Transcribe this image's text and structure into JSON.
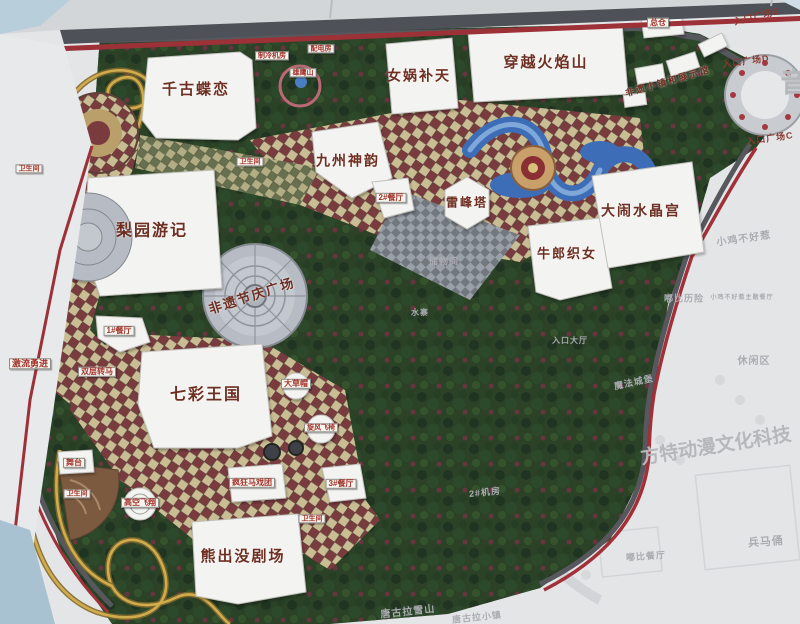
{
  "meta": {
    "description": "Photograph of a printed theme-park master-plan map board (Fantawild-style Chinese theme park). Colourful phase highlighted; adjacent areas shown faded grey.",
    "board_type": "site plan map"
  },
  "palette": {
    "board": "#e4e5e7",
    "park-green": "#2b4227",
    "checker-tan": "#c9bd93",
    "checker-maroon": "#7a3b3f",
    "checker-olive": "#66704e",
    "plaza": "#b7bcc4",
    "water": "#3e6db8",
    "road-red": "#a23038",
    "road-gray": "#56585e",
    "coaster": "#d0ac4d",
    "building": "#f3f3f1",
    "label-red": "#6e2f22",
    "faded-text": "#aaacb1"
  },
  "labels": {
    "attractions": [
      {
        "id": "qiangudielian",
        "text": "千古蝶恋",
        "x": 196,
        "y": 90,
        "size": 15
      },
      {
        "id": "nvwabutian",
        "text": "女娲补天",
        "x": 419,
        "y": 76,
        "size": 14
      },
      {
        "id": "chuanyuehuoyanshan",
        "text": "穿越火焰山",
        "x": 546,
        "y": 63,
        "size": 15
      },
      {
        "id": "jiuzhoushenyun",
        "text": "九州神韵",
        "x": 348,
        "y": 161,
        "size": 14
      },
      {
        "id": "liyuanyouji",
        "text": "梨园游记",
        "x": 152,
        "y": 232,
        "size": 16
      },
      {
        "id": "leifengta",
        "text": "雷峰塔",
        "x": 467,
        "y": 203,
        "size": 12
      },
      {
        "id": "niulangzhinv",
        "text": "牛郎织女",
        "x": 567,
        "y": 254,
        "size": 13
      },
      {
        "id": "danaoshuijinggong",
        "text": "大闹水晶宫",
        "x": 641,
        "y": 211,
        "size": 14
      },
      {
        "id": "qicaiwangguo",
        "text": "七彩王国",
        "x": 206,
        "y": 396,
        "size": 16
      },
      {
        "id": "xiongchumojuchang",
        "text": "熊出没剧场",
        "x": 243,
        "y": 557,
        "size": 15
      },
      {
        "id": "feiyijieqingguangchang",
        "text": "非遗节庆广场",
        "x": 252,
        "y": 296,
        "size": 13,
        "rot": -18
      },
      {
        "id": "feiyixiaozhen",
        "text": "非遗小镇和展示馆",
        "x": 668,
        "y": 82,
        "size": 9,
        "rot": -16
      }
    ],
    "facilities": [
      {
        "id": "zongcang",
        "text": "总仓",
        "x": 658,
        "y": 23,
        "size": 8
      },
      {
        "id": "zhilengjifang",
        "text": "制冷机房",
        "x": 272,
        "y": 56,
        "size": 7
      },
      {
        "id": "peidianfang",
        "text": "配电房",
        "x": 321,
        "y": 49,
        "size": 7
      },
      {
        "id": "xiongyingshan",
        "text": "雄鹰山",
        "x": 303,
        "y": 73,
        "size": 7
      },
      {
        "id": "weishengjian-1",
        "text": "卫生间",
        "x": 29,
        "y": 169,
        "size": 7
      },
      {
        "id": "weishengjian-2",
        "text": "卫生间",
        "x": 250,
        "y": 162,
        "size": 7
      },
      {
        "id": "weishengjian-3",
        "text": "卫生间",
        "x": 77,
        "y": 494,
        "size": 7
      },
      {
        "id": "weishengjian-4",
        "text": "卫生间",
        "x": 312,
        "y": 519,
        "size": 7
      },
      {
        "id": "canting-1",
        "text": "1#餐厅",
        "x": 119,
        "y": 331,
        "size": 8
      },
      {
        "id": "canting-2",
        "text": "2#餐厅",
        "x": 391,
        "y": 198,
        "size": 8
      },
      {
        "id": "canting-3",
        "text": "3#餐厅",
        "x": 341,
        "y": 484,
        "size": 8
      },
      {
        "id": "dacaomao",
        "text": "大草帽",
        "x": 296,
        "y": 384,
        "size": 8
      },
      {
        "id": "xuanfengfeiyi",
        "text": "旋风飞椅",
        "x": 321,
        "y": 428,
        "size": 7
      },
      {
        "id": "shuangcengzhuanma",
        "text": "双层转马",
        "x": 97,
        "y": 372,
        "size": 8
      },
      {
        "id": "gaokongfeixiang",
        "text": "高空飞翔",
        "x": 140,
        "y": 503,
        "size": 8
      },
      {
        "id": "wutai",
        "text": "舞台",
        "x": 74,
        "y": 463,
        "size": 8
      },
      {
        "id": "fengkuangmaxituan",
        "text": "疯狂马戏团",
        "x": 252,
        "y": 483,
        "size": 8
      },
      {
        "id": "jiliuyongjin",
        "text": "激流勇进",
        "x": 30,
        "y": 364,
        "size": 9
      }
    ],
    "entrances": [
      {
        "id": "rukouguangchang-E",
        "text": "入口广场E",
        "x": 757,
        "y": 17,
        "size": 9,
        "rot": -14
      },
      {
        "id": "rukouguangchang-D",
        "text": "入口广场D",
        "x": 746,
        "y": 62,
        "size": 9,
        "rot": -8
      },
      {
        "id": "rukouguangchang-C",
        "text": "入口广场C",
        "x": 770,
        "y": 139,
        "size": 9,
        "rot": -8
      }
    ],
    "faded": [
      {
        "id": "chuwujian",
        "text": "储物间",
        "x": 444,
        "y": 262,
        "size": 9
      },
      {
        "id": "xiaojibuhaore",
        "text": "小鸡不好惹",
        "x": 744,
        "y": 240,
        "size": 10,
        "rot": -8
      },
      {
        "id": "dubilixian",
        "text": "嘟比历险",
        "x": 684,
        "y": 299,
        "size": 9
      },
      {
        "id": "xiaojicanting",
        "text": "小鸡不好惹主题餐厅",
        "x": 742,
        "y": 298,
        "size": 6
      },
      {
        "id": "xiuxianqu",
        "text": "休闲区",
        "x": 754,
        "y": 362,
        "size": 10
      },
      {
        "id": "mofachengbao",
        "text": "魔法城堡",
        "x": 634,
        "y": 383,
        "size": 9,
        "rot": -12
      },
      {
        "id": "rukoudating",
        "text": "入口大厅",
        "x": 570,
        "y": 341,
        "size": 8
      },
      {
        "id": "shuizhai",
        "text": "水寨",
        "x": 420,
        "y": 313,
        "size": 8
      },
      {
        "id": "jifang-2",
        "text": "2#机房",
        "x": 485,
        "y": 493,
        "size": 9,
        "rot": -6
      },
      {
        "id": "tanggulaxueshan",
        "text": "唐古拉雪山",
        "x": 408,
        "y": 613,
        "size": 10,
        "rot": -6
      },
      {
        "id": "tanggulaxiaozhen",
        "text": "唐古拉小镇",
        "x": 477,
        "y": 618,
        "size": 9,
        "rot": -6
      },
      {
        "id": "dubicanting",
        "text": "嘟比餐厅",
        "x": 646,
        "y": 557,
        "size": 9,
        "rot": -4
      },
      {
        "id": "bingmayong",
        "text": "兵马俑",
        "x": 766,
        "y": 543,
        "size": 11,
        "rot": -4
      }
    ],
    "watermarks": [
      {
        "id": "fangte-watermark",
        "text": "方特动漫文化科技",
        "x": 716,
        "y": 447,
        "size": 19,
        "rot": -9
      },
      {
        "id": "yin-partial",
        "text": "音",
        "x": 794,
        "y": 83,
        "size": 27
      }
    ]
  }
}
